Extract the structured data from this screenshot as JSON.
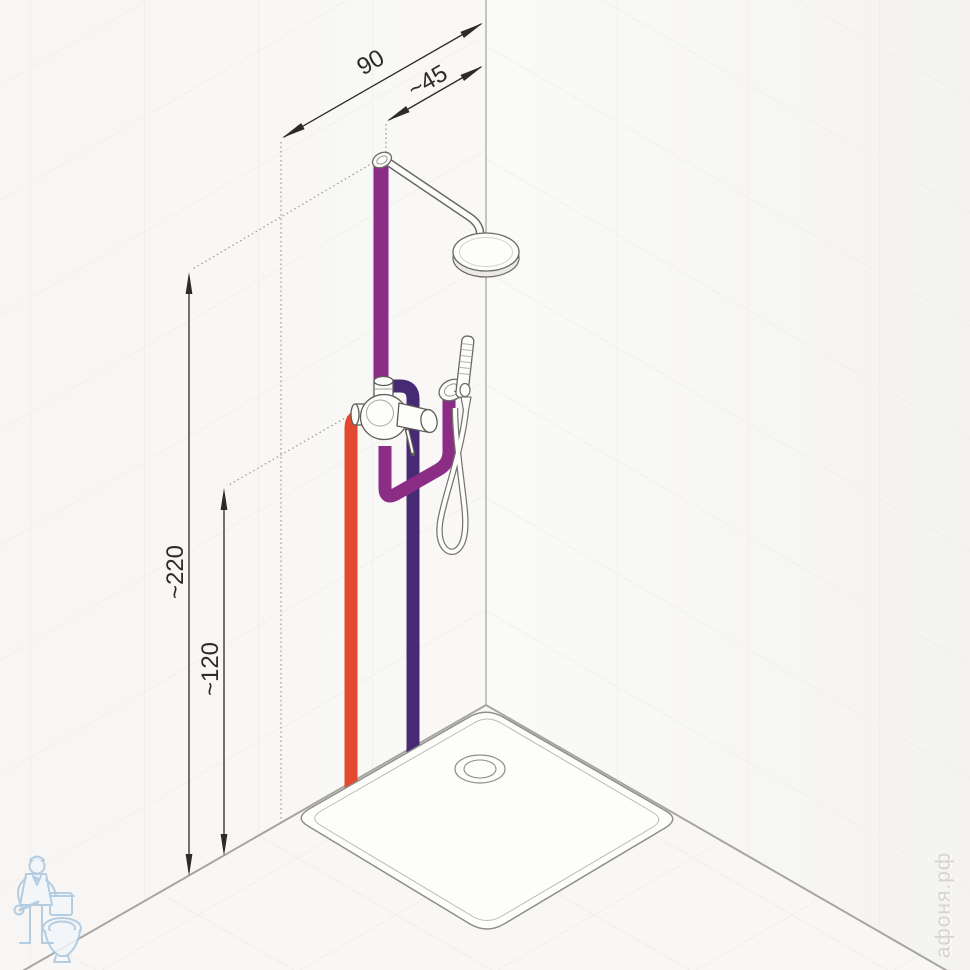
{
  "dimensions": {
    "width_90": "90",
    "offset_45": "~45",
    "height_220": "~220",
    "height_120": "~120"
  },
  "colors": {
    "hot_pipe": "#e2492f",
    "cold_pipe": "#472a74",
    "mixed_pipe": "#8b2d85",
    "watermark_blue": "#a9c6de",
    "watermark_text_color": "#d7d4cf"
  },
  "watermark": {
    "site": "афоня.рф",
    "logo": "plumber-with-toilet-icon"
  }
}
